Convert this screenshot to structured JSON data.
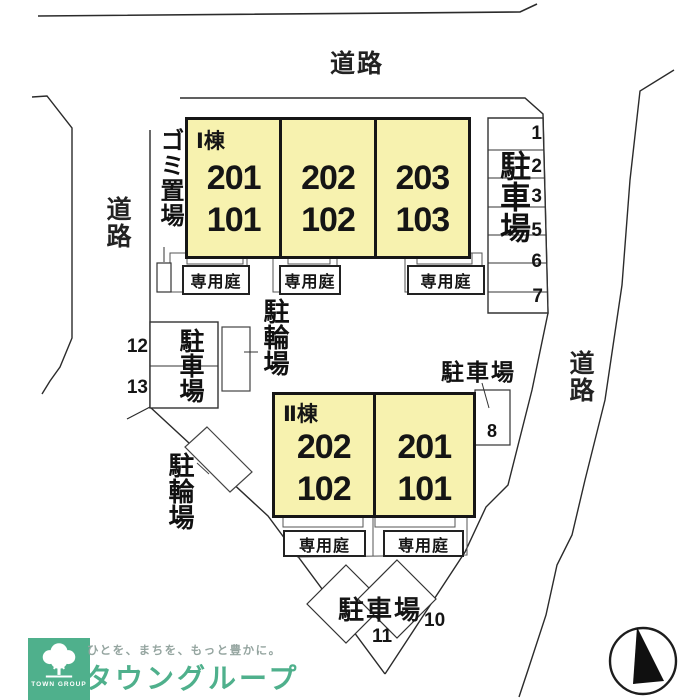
{
  "plan": {
    "roads": {
      "top": "道路",
      "left": "道路",
      "right": "道路"
    },
    "building_1": {
      "name": "Ⅰ棟",
      "units": [
        {
          "upper": "201",
          "lower": "101"
        },
        {
          "upper": "202",
          "lower": "102"
        },
        {
          "upper": "203",
          "lower": "103"
        }
      ]
    },
    "building_2": {
      "name": "Ⅱ棟",
      "units": [
        {
          "upper": "202",
          "lower": "102"
        },
        {
          "upper": "201",
          "lower": "101"
        }
      ]
    },
    "garden_label": "専用庭",
    "garbage_area": {
      "label": "ゴミ置場"
    },
    "bicycle_parking_upper": {
      "label": "駐輪場"
    },
    "bicycle_parking_lower": {
      "label": "駐輪場"
    },
    "parking_right": {
      "label": "駐車場",
      "spaces": [
        "1",
        "2",
        "3",
        "5",
        "6",
        "7"
      ]
    },
    "parking_left": {
      "label": "駐車場",
      "spaces": [
        "12",
        "13"
      ]
    },
    "parking_single": {
      "label": "駐車場",
      "space": "8"
    },
    "parking_bottom": {
      "label": "駐車場",
      "spaces": [
        "11",
        "10"
      ]
    }
  },
  "footer": {
    "logo_text": "TOWN GROUP",
    "tagline": "ひとを、まちを、もっと豊かに。",
    "brand": "タウングループ"
  },
  "colors": {
    "building_fill": "#F7F2AF",
    "line_dark": "#2B2B2B",
    "brand_green": "#4FB08C",
    "tagline_gray": "#95A5A0"
  }
}
